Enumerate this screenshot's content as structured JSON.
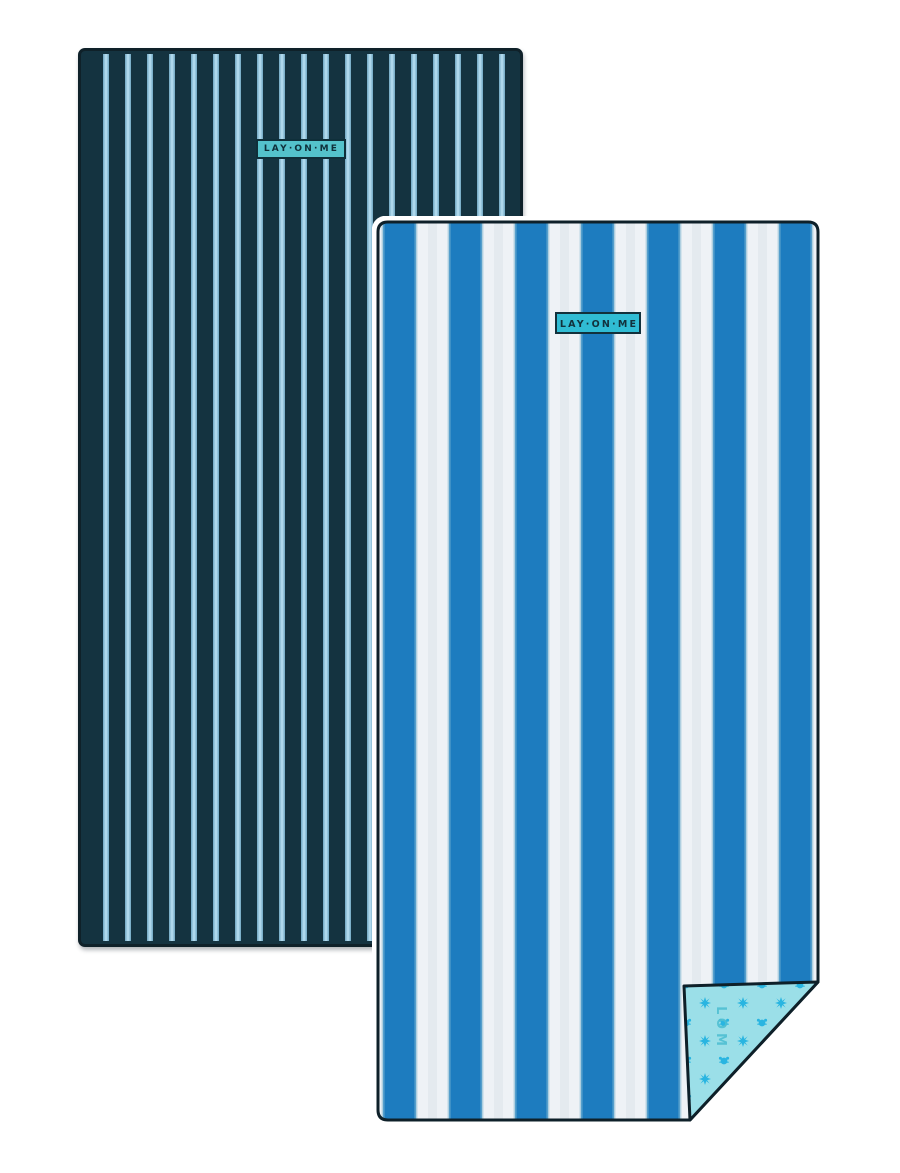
{
  "product": {
    "description": "Two striped beach towels product image",
    "left_towel": {
      "style": "navy pinstripe",
      "label": "LAY·ON·ME",
      "colors": {
        "base": "#143340",
        "stripe": "#aed8ec",
        "stripe_edge": "#7cb0ca",
        "outline": "#0f2129",
        "label_bg": "#54c2cb",
        "label_text": "#0f2f3a"
      }
    },
    "right_towel": {
      "style": "blue cabana stripe",
      "label": "LAY·ON·ME",
      "monogram": "LOM",
      "colors": {
        "blue_stripe": "#1d7cbf",
        "white_stripe": "#eef2f6",
        "outline": "#0e2029",
        "label_bg": "#30bcd4",
        "label_text": "#12313c",
        "fold_back": "#9bdfe8",
        "fold_motif": "#29b5e1",
        "monogram_color": "#4fbfd2"
      },
      "fold_motifs": [
        "sun-icon",
        "crab-icon"
      ]
    },
    "page_background": "#ffffff"
  }
}
